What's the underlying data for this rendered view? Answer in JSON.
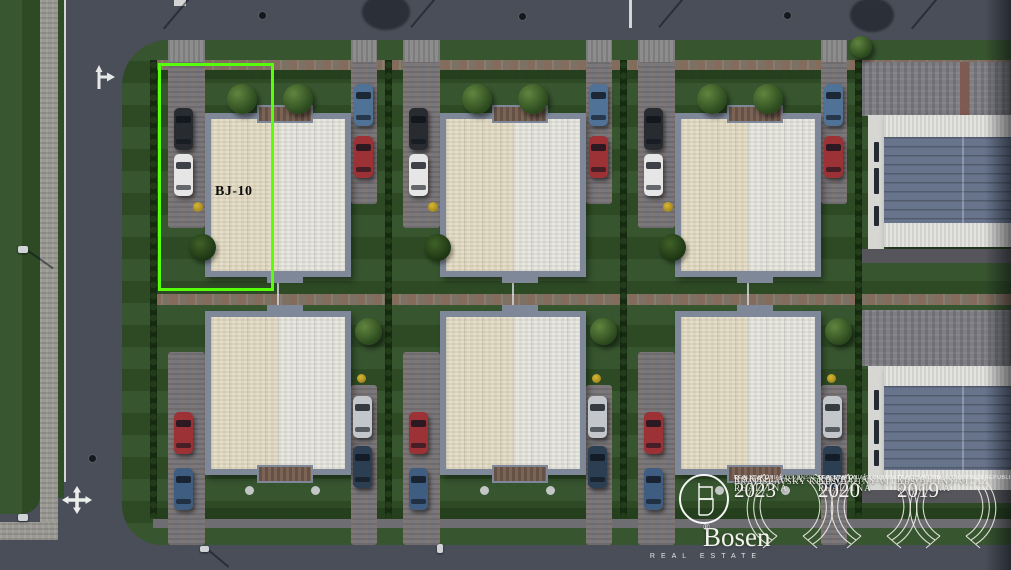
{
  "plot": {
    "label": "BJ-10"
  },
  "watermark": {
    "brand": "Bosen",
    "registered_mark": "®",
    "tagline": "REAL ESTATE",
    "badges": [
      {
        "title_lines": [
          "REALITNÁ",
          "KANCELÁRIA",
          "ROKA"
        ],
        "year": "2023",
        "award": "BRATISLAVSKÝ KRAJ",
        "organization": "REALITNÁ ÚNIA SLOVENSKEJ REPUBLIKY"
      },
      {
        "title_lines": [
          "REALITNÁ",
          "KANCELÁRIA",
          "ROKA"
        ],
        "year": "2020",
        "award": "ABSOLÚTNY VÍŤAZ",
        "organization": "REALITNÁ ÚNIA SLOVENSKEJ REPUBLIKY"
      },
      {
        "title_lines": [
          "REALITNÁ",
          "KANCELÁRIA",
          "ROKA"
        ],
        "year": "2019",
        "award": "ABSOLÚTNY VÍŤAZ",
        "organization": "REALITNÁ ÚNIA SLOVENSKEJ REPUBLIKY"
      }
    ]
  },
  "palette": {
    "highlight": "#58ff0a",
    "road": "#4a4e58",
    "lawn": "#2f4e27",
    "sidewalk": "#9b9994",
    "paving": "#77777d",
    "hedge": "#1c3315",
    "roof_left": "#e6dfc8",
    "roof_right": "#e9e9e3",
    "roof_border": "#7e8899",
    "hall_roof": "#68748c",
    "gravel": "#e3e3df",
    "car_dark": "#282b30",
    "car_white": "#e6e6e6",
    "car_blue": "#4f7296",
    "car_red": "#9c3136",
    "car_silver": "#c3c7cb",
    "car_navy": "#2c3e52",
    "car_steel": "#3f5d80"
  }
}
